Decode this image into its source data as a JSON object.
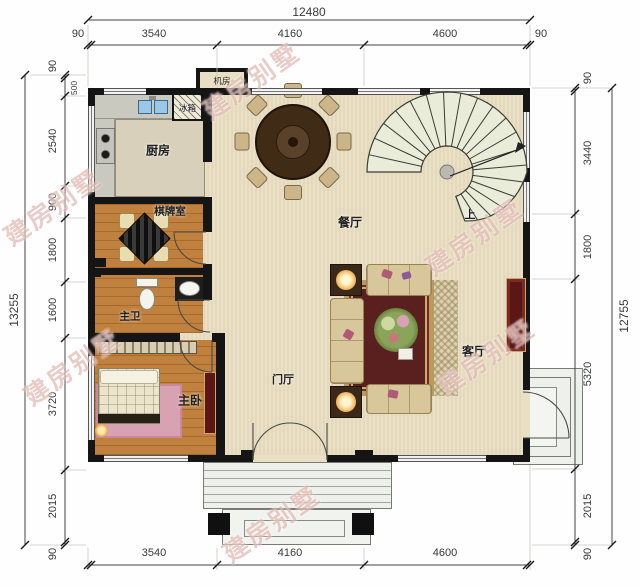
{
  "watermark": {
    "text": "建房别墅"
  },
  "dimensions": {
    "top": {
      "total": "12480",
      "segments": [
        "90",
        "3540",
        "4160",
        "4600",
        "90"
      ]
    },
    "bottom": {
      "segments": [
        "3540",
        "4160",
        "4600"
      ]
    },
    "left": {
      "total": "13255",
      "segments": [
        "90",
        "500",
        "2540",
        "900",
        "1800",
        "1600",
        "3720",
        "2015",
        "90"
      ]
    },
    "right": {
      "total": "12755",
      "segments": [
        "90",
        "3440",
        "1800",
        "5320",
        "2015",
        "90"
      ]
    }
  },
  "rooms": {
    "machine_room": "机房",
    "fridge": "冰箱",
    "kitchen": "厨房",
    "chess_room": "棋牌室",
    "dining_room": "餐厅",
    "master_bath": "主卫",
    "foyer": "门厅",
    "master_bedroom": "主卧",
    "living_room": "客厅",
    "stairs_up": "上"
  },
  "colors": {
    "wall": "#151515",
    "floor_main": "#e9dfc4",
    "floor_wood": "#c0803e",
    "floor_kitchen": "#d8d0ba",
    "rug_red": "#5a2020",
    "cabinet_red": "#5c1616",
    "sink_blue": "#9cc8e8",
    "stair_tread": "#e9ecd9",
    "porch_gray": "#eef0ec",
    "watermark": "#c67868"
  }
}
